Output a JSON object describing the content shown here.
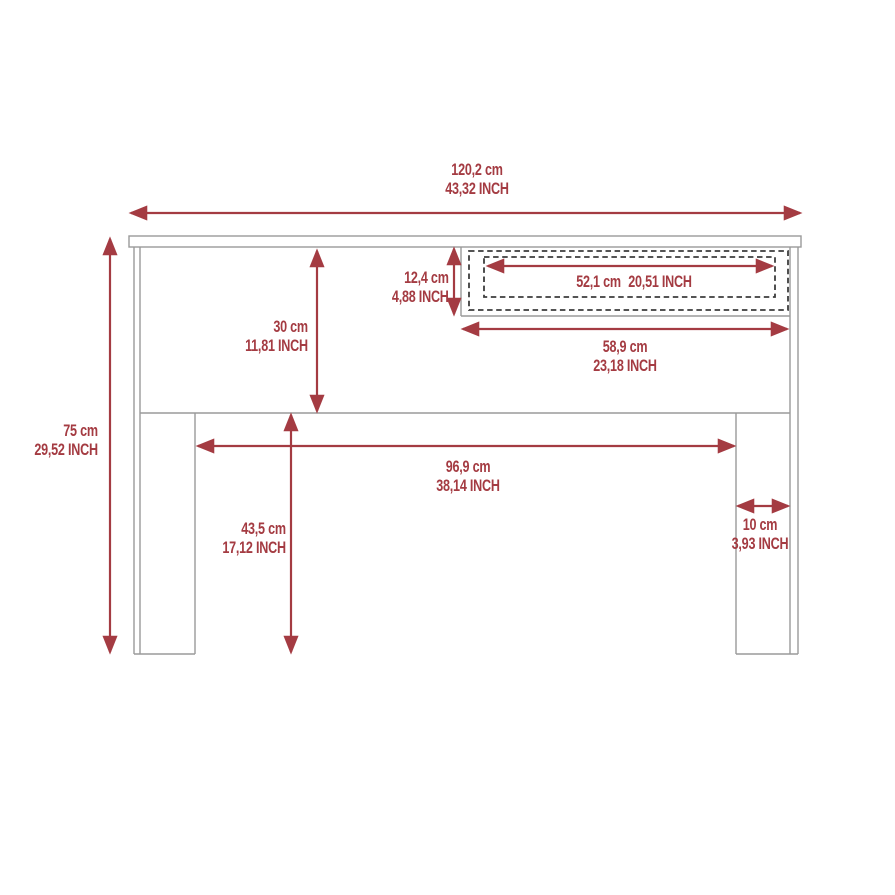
{
  "diagram": {
    "type": "furniture-dimension-drawing",
    "view": "front",
    "colors": {
      "dimension_red": "#a43b42",
      "outline_gray": "#9a9a9a",
      "drawer_dashed": "#3c3c3c",
      "background": "#ffffff"
    },
    "dimensions": {
      "overall_width": {
        "cm": "120,2 cm",
        "inch": "43,32 INCH"
      },
      "overall_height": {
        "cm": "75 cm",
        "inch": "29,52 INCH"
      },
      "panel_height": {
        "cm": "30 cm",
        "inch": "11,81 INCH"
      },
      "drawer_height": {
        "cm": "12,4 cm",
        "inch": "4,88 INCH"
      },
      "drawer_inner_width": {
        "cm": "52,1 cm",
        "inch": "20,51 INCH"
      },
      "drawer_width": {
        "cm": "58,9 cm",
        "inch": "23,18 INCH"
      },
      "inner_width": {
        "cm": "96,9 cm",
        "inch": "38,14 INCH"
      },
      "leg_height": {
        "cm": "43,5 cm",
        "inch": "17,12 INCH"
      },
      "leg_width": {
        "cm": "10 cm",
        "inch": "3,93 INCH"
      }
    }
  }
}
